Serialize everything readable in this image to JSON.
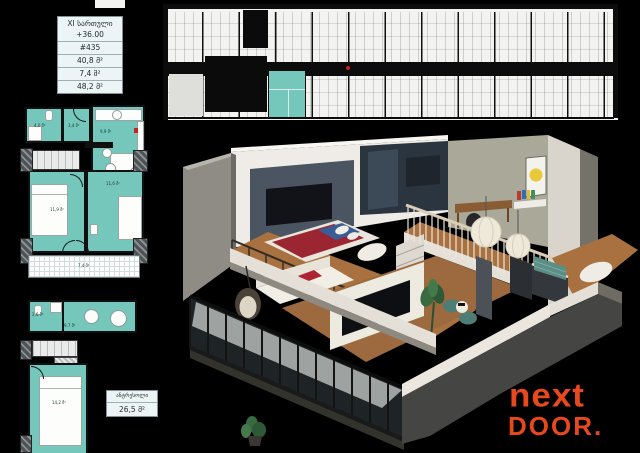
{
  "colors": {
    "background": "#000000",
    "teal": "#74c7ba",
    "logo": "#e8481d"
  },
  "info_box": {
    "floor": "XI სართული",
    "elevation": "+36.00",
    "unit_number": "#435",
    "area_living": "40,8 მ²",
    "area_balcony": "7,4 მ²",
    "area_total": "48,2 მ²"
  },
  "mezzanine_box": {
    "title": "ანტრესოლი",
    "area": "26,5 მ²"
  },
  "plan_upper": {
    "areas": {
      "bathroom": "4,0 მ²",
      "hall": "3,4 მ²",
      "kitchen": "9,9 მ²",
      "bedroom": "11,9 მ²",
      "living": "11,6 მ²",
      "balcony": "7,4 მ²"
    }
  },
  "plan_mezzanine": {
    "areas": {
      "bathroom": "2,6 მ²",
      "hall": "9,7 მ²",
      "bedroom": "14,2 მ²"
    }
  },
  "logo": {
    "line1": "next",
    "line2": "DOOR."
  }
}
